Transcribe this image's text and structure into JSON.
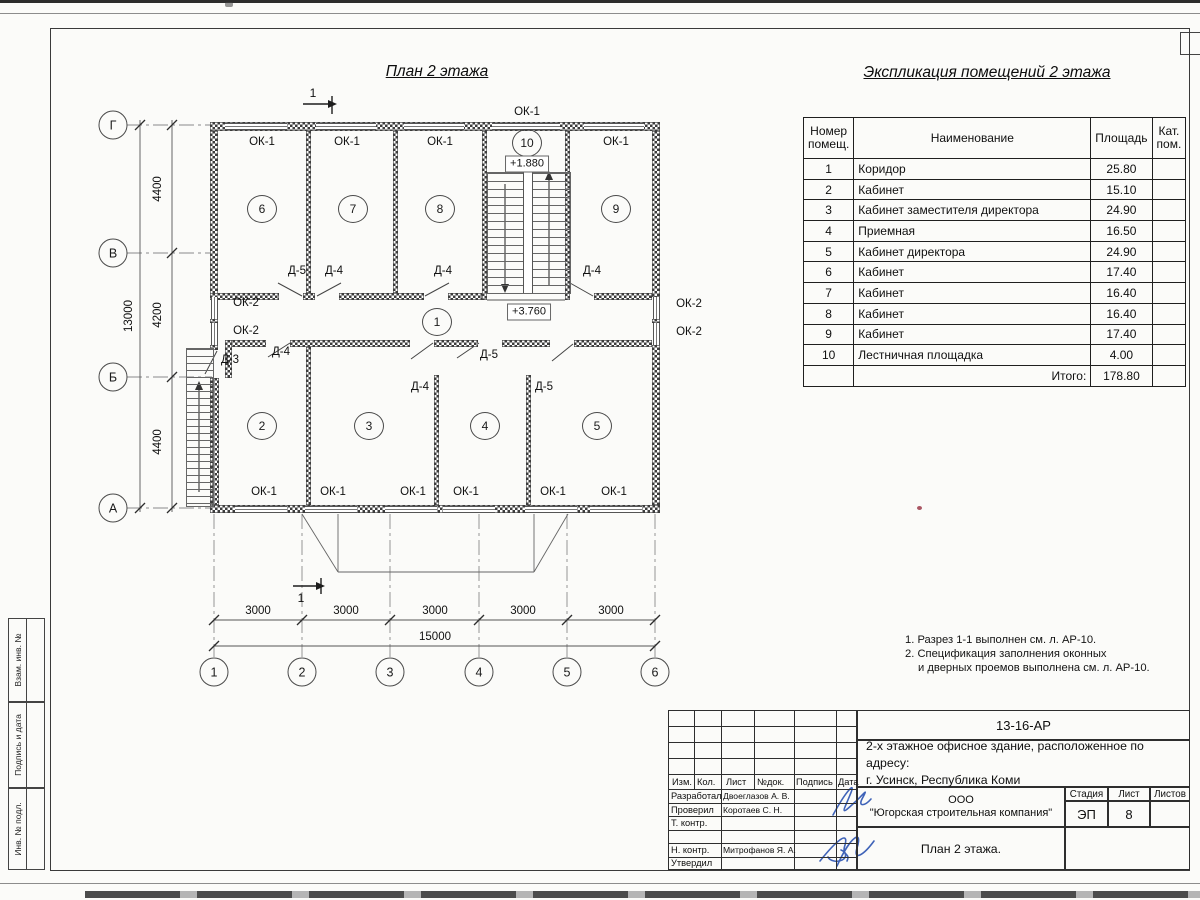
{
  "sheet": {
    "plan_title": "План 2 этажа",
    "explication_title": "Экспликация помещений 2 этажа"
  },
  "labels": {
    "ok1": "ОК-1",
    "ok2": "ОК-2",
    "d3": "Д-3",
    "d4": "Д-4",
    "d5": "Д-5",
    "section": "1"
  },
  "levels": {
    "stair_mid": "+1.880",
    "floor": "+3.760"
  },
  "rooms": [
    "1",
    "2",
    "3",
    "4",
    "5",
    "6",
    "7",
    "8",
    "9",
    "10"
  ],
  "axes": {
    "bottom": [
      "1",
      "2",
      "3",
      "4",
      "5",
      "6"
    ],
    "left": [
      "Г",
      "В",
      "Б",
      "А"
    ]
  },
  "dims": {
    "bay": "3000",
    "total_width": "15000",
    "left": [
      "4400",
      "4200",
      "4400"
    ],
    "total_height": "13000"
  },
  "explication": {
    "col_number": "Номер помещ.",
    "col_name": "Наименование",
    "col_area": "Площадь",
    "col_cat": "Кат. пом.",
    "rows": [
      [
        "1",
        "Коридор",
        "25.80"
      ],
      [
        "2",
        "Кабинет",
        "15.10"
      ],
      [
        "3",
        "Кабинет заместителя директора",
        "24.90"
      ],
      [
        "4",
        "Приемная",
        "16.50"
      ],
      [
        "5",
        "Кабинет директора",
        "24.90"
      ],
      [
        "6",
        "Кабинет",
        "17.40"
      ],
      [
        "7",
        "Кабинет",
        "16.40"
      ],
      [
        "8",
        "Кабинет",
        "16.40"
      ],
      [
        "9",
        "Кабинет",
        "17.40"
      ],
      [
        "10",
        "Лестничная площадка",
        "4.00"
      ]
    ],
    "total_label": "Итого:",
    "total_value": "178.80"
  },
  "notes": [
    "1. Разрез 1-1 выполнен см. л. АР-10.",
    "2. Спецификация заполнения оконных",
    "и дверных проемов выполнена см. л. АР-10."
  ],
  "sidebar": [
    "Взам. инв. №",
    "Подпись и дата",
    "Инв. № подл."
  ],
  "stamp": {
    "doc_number": "13-16-АР",
    "title_line1": "2-х этажное офисное здание, расположенное по адресу:",
    "title_line2": "г. Усинск, Республика Коми",
    "cols": [
      "Изм.",
      "Кол.",
      "Лист",
      "№док.",
      "Подпись",
      "Дата"
    ],
    "rows": [
      [
        "Разработал",
        "Двоеглазов А. В."
      ],
      [
        "Проверил",
        "Коротаев С. Н."
      ],
      [
        "Т. контр.",
        ""
      ],
      [
        "",
        ""
      ],
      [
        "Н. контр.",
        "Митрофанов Я. А."
      ],
      [
        "Утвердил",
        ""
      ]
    ],
    "company_line1": "ООО",
    "company_line2": "\"Югорская строительная компания\"",
    "stage_label": "Стадия",
    "sheet_label": "Лист",
    "sheets_label": "Листов",
    "stage": "ЭП",
    "sheet": "8",
    "sheets": "",
    "drawing_name": "План 2 этажа."
  }
}
